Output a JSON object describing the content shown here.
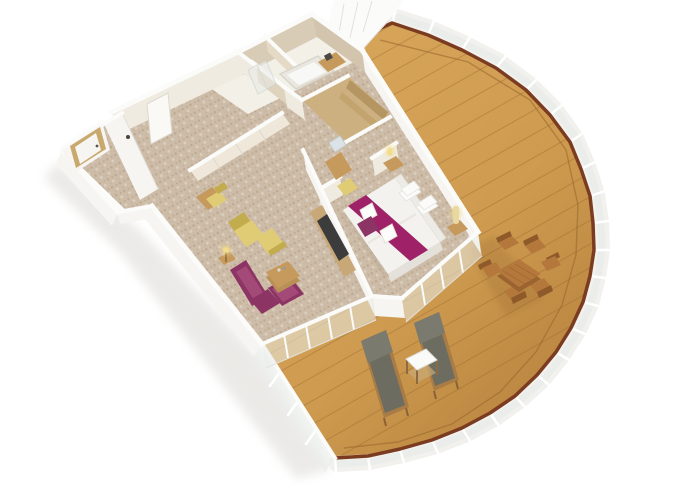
{
  "meta": {
    "description": "Isometric 3D cutaway floor plan of a ship suite with entrance hall, bathroom, walk-in closet, living room, bedroom and a large curved wrap-around balcony",
    "view": "isometric-cutaway"
  },
  "colors": {
    "balcony_wood": "#ce9b50",
    "plank_line": "#96662c",
    "handrail": "#7b3b20",
    "railing_white": "#f2f1ee",
    "glass": "#e9ece9",
    "wall": "#f6f5f2",
    "wall_top": "#fbfbf9",
    "wall_face": "#f0ebe1",
    "bath_wall": "#d9ccb6",
    "bath_floor": "#f3f0e8",
    "carpet": "#cdbca8",
    "carpet_dot": "#b9a38a",
    "closet_wood": "#cdb080",
    "closet_shelf": "#b3945e",
    "wood_furniture": "#c69a5c",
    "dining_wood": "#b5783c",
    "dining_dark": "#8f5a2a",
    "magenta": "#8c3463",
    "magenta_light": "#a34a79",
    "runner": "#9f2168",
    "yellow": "#dfcc74",
    "yellow_dark": "#c3ac4e",
    "lounger": "#6c6c60",
    "lounger_frame": "#a97c46",
    "bed_white": "#f4f2ef",
    "pillow": "#fbfbf9",
    "tv_dark": "#3c3c3c",
    "mirror": "#dce3e6",
    "lamp_glow": "#f2dc8c",
    "door_wood": "#c9a86b",
    "shadow": "#d8d6d1"
  },
  "rooms": [
    {
      "name": "entrance-hall",
      "furniture": [
        "entry-door",
        "interior-door",
        "wardrobe-doors"
      ]
    },
    {
      "name": "bathroom",
      "furniture": [
        "bathtub",
        "shower",
        "vanity-counter"
      ]
    },
    {
      "name": "walk-in-closet",
      "furniture": [
        "shelves"
      ]
    },
    {
      "name": "living-room",
      "furniture": [
        "desk",
        "desk-chair",
        "chaise-lounge",
        "floor-lamp",
        "corner-sofa",
        "coffee-table",
        "tv-panel"
      ]
    },
    {
      "name": "bedroom",
      "furniture": [
        "double-bed",
        "bed-runner",
        "pillows",
        "towels",
        "nightstands",
        "table-lamps",
        "vanity-table",
        "vanity-stool",
        "mirror",
        "foot-bench"
      ]
    },
    {
      "name": "balcony",
      "furniture": [
        "dining-table",
        "dining-chairs",
        "sun-loungers",
        "side-table"
      ]
    }
  ],
  "counts": {
    "pillows": 4,
    "towels_on_bed": 2,
    "dining_chairs": 6,
    "sun_loungers": 2,
    "nightstands": 2
  },
  "railing": {
    "style": "glass panels with wooden handrail and white posts",
    "shape": "curved"
  }
}
